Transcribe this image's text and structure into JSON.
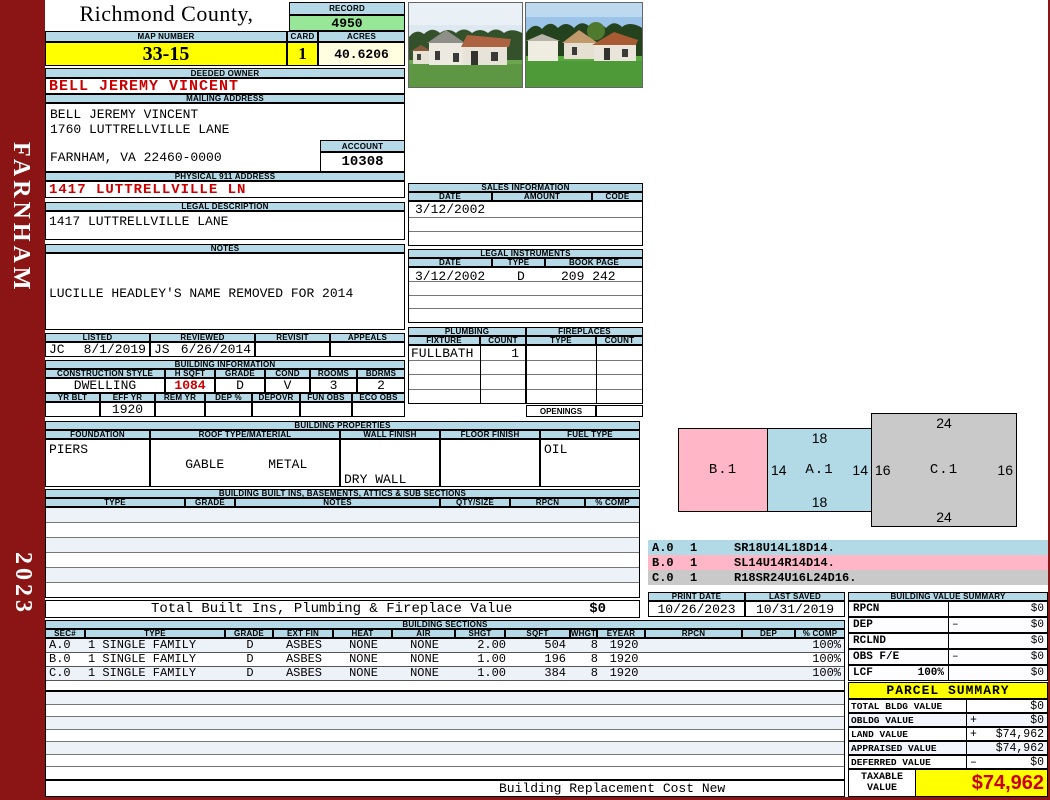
{
  "colors": {
    "frame_maroon": "#8b1414",
    "header_blue": "#b5d9e7",
    "record_green": "#98e698",
    "highlight_yellow": "#ffff00",
    "acres_cream": "#fffee0",
    "alert_red": "#cc0000",
    "sketch_pink": "#ffb6c6",
    "sketch_blue": "#b2dae6",
    "sketch_gray": "#c9c9c9"
  },
  "sidebar": {
    "district": "FARNHAM",
    "year": "2023"
  },
  "header": {
    "county_title": "Richmond County, Virginia",
    "county_subtitle": "Commissioner of the Revenue, PO Box 366, Warsaw, VA 22572",
    "record_label": "RECORD",
    "record_number": "4950",
    "map_number_label": "MAP NUMBER",
    "map_number": "33-15",
    "card_label": "CARD",
    "card_number": "1",
    "acres_label": "ACRES",
    "acres": "40.6206"
  },
  "owner": {
    "deeded_owner_label": "DEEDED OWNER",
    "deeded_owner": "BELL JEREMY VINCENT",
    "mailing_address_label": "MAILING ADDRESS",
    "mailing_line1": "BELL JEREMY VINCENT",
    "mailing_line2": "1760 LUTTRELLVILLE LANE",
    "mailing_line3": "FARNHAM, VA 22460-0000",
    "account_label": "ACCOUNT",
    "account_number": "10308",
    "physical_address_label": "PHYSICAL 911 ADDRESS",
    "physical_address": "1417 LUTTRELLVILLE LN",
    "legal_description_label": "LEGAL DESCRIPTION",
    "legal_description": "1417 LUTTRELLVILLE LANE",
    "notes_label": "NOTES",
    "notes_line1": "LUCILLE HEADLEY'S NAME REMOVED FOR 2014",
    "notes_line2": "(DIED 6/19/13) DB 209-242 TO JEREMY V",
    "notes_line3": "BELL"
  },
  "review": {
    "listed_label": "LISTED",
    "reviewed_label": "REVIEWED",
    "revisit_label": "REVISIT",
    "appeals_label": "APPEALS",
    "listed_by": "JC",
    "listed_date": "8/1/2019",
    "reviewed_by": "JS",
    "reviewed_date": "6/26/2014",
    "revisit": "",
    "appeals": ""
  },
  "building_info": {
    "title": "BUILDING INFORMATION",
    "construction_style_label": "CONSTRUCTION STYLE",
    "construction_style": "DWELLING",
    "h_sqft_label": "H SQFT",
    "h_sqft": "1084",
    "grade_label": "GRADE",
    "grade": "D",
    "cond_label": "COND",
    "cond": "V",
    "rooms_label": "ROOMS",
    "rooms": "3",
    "bdrms_label": "BDRMS",
    "bdrms": "2",
    "yr_blt_label": "YR BLT",
    "yr_blt": "",
    "eff_yr_label": "EFF YR",
    "eff_yr": "1920",
    "rem_yr_label": "REM YR",
    "rem_yr": "",
    "dep_pct_label": "DEP %",
    "dep_pct": "",
    "depovr_label": "DEPOVR",
    "depovr": "",
    "fun_obs_label": "FUN OBS",
    "fun_obs": "",
    "eco_obs_label": "ECO OBS",
    "eco_obs": ""
  },
  "building_props": {
    "title": "BUILDING PROPERTIES",
    "foundation_label": "FOUNDATION",
    "foundation": "PIERS",
    "roof_label": "ROOF TYPE/MATERIAL",
    "roof_type": "GABLE",
    "roof_material": "METAL",
    "wall_label": "WALL FINISH",
    "wall_finish1": "DRY WALL",
    "wall_finish2": "PLASTER",
    "floor_label": "FLOOR FINISH",
    "floor_finish": "",
    "fuel_label": "FUEL TYPE",
    "fuel_type": "OIL"
  },
  "built_ins": {
    "title": "BUILDING BUILT INS, BASEMENTS, ATTICS & SUB SECTIONS",
    "headers": [
      "TYPE",
      "GRADE",
      "NOTES",
      "QTY/SIZE",
      "RPCN",
      "% COMP"
    ]
  },
  "totals": {
    "built_ins_label": "Total Built Ins, Plumbing & Fireplace Value",
    "built_ins_value": "$0"
  },
  "sales": {
    "title": "SALES INFORMATION",
    "date_label": "DATE",
    "amount_label": "AMOUNT",
    "code_label": "CODE",
    "rows": [
      {
        "date": "3/12/2002",
        "amount": "",
        "code": ""
      }
    ]
  },
  "legal_instruments": {
    "title": "LEGAL INSTRUMENTS",
    "date_label": "DATE",
    "type_label": "TYPE",
    "bookpage_label": "BOOK PAGE",
    "rows": [
      {
        "date": "3/12/2002",
        "type": "D",
        "bookpage": "209 242"
      }
    ]
  },
  "plumbing": {
    "title": "PLUMBING",
    "fixture_label": "FIXTURE",
    "count_label": "COUNT",
    "rows": [
      {
        "fixture": "FULLBATH",
        "count": "1"
      }
    ]
  },
  "fireplaces": {
    "title": "FIREPLACES",
    "type_label": "TYPE",
    "count_label": "COUNT",
    "openings_label": "OPENINGS",
    "openings_value": ""
  },
  "sketch": {
    "b1": {
      "id": "B.1"
    },
    "a1": {
      "id": "A.1",
      "top": "18",
      "left": "14",
      "right": "14",
      "bottom": "18"
    },
    "c1": {
      "id": "C.1",
      "top": "24",
      "left": "16",
      "right": "16",
      "bottom": "24"
    },
    "legend": [
      {
        "sec": "A.0",
        "count": "1",
        "trace": "SR18U14L18D14."
      },
      {
        "sec": "B.0",
        "count": "1",
        "trace": "SL14U14R14D14."
      },
      {
        "sec": "C.0",
        "count": "1",
        "trace": "R18SR24U16L24D16."
      }
    ]
  },
  "dates": {
    "print_date_label": "PRINT DATE",
    "print_date": "10/26/2023",
    "last_saved_label": "LAST SAVED",
    "last_saved": "10/31/2019"
  },
  "bvs": {
    "title": "BUILDING VALUE SUMMARY",
    "rows": [
      {
        "label": "RPCN",
        "extra": "",
        "op": "",
        "value": "$0"
      },
      {
        "label": "DEP",
        "extra": "",
        "op": "–",
        "value": "$0"
      },
      {
        "label": "RCLND",
        "extra": "",
        "op": "",
        "value": "$0"
      },
      {
        "label": "OBS F/E",
        "extra": "",
        "op": "–",
        "value": "$0"
      },
      {
        "label": "LCF",
        "extra": "100%",
        "op": "",
        "value": "$0"
      }
    ]
  },
  "building_sections": {
    "title": "BUILDING SECTIONS",
    "headers": [
      "SEC#",
      "TYPE",
      "GRADE",
      "EXT FIN",
      "HEAT",
      "AIR",
      "SHGT",
      "SQFT",
      "WHGT",
      "EYEAR",
      "RPCN",
      "DEP",
      "% COMP"
    ],
    "rows": [
      [
        "A.0",
        "1 SINGLE FAMILY",
        "D",
        "ASBES",
        "NONE",
        "NONE",
        "2.00",
        "504",
        "8",
        "1920",
        "",
        "",
        "100%"
      ],
      [
        "B.0",
        "1 SINGLE FAMILY",
        "D",
        "ASBES",
        "NONE",
        "NONE",
        "1.00",
        "196",
        "8",
        "1920",
        "",
        "",
        "100%"
      ],
      [
        "C.0",
        "1 SINGLE FAMILY",
        "D",
        "ASBES",
        "NONE",
        "NONE",
        "1.00",
        "384",
        "8",
        "1920",
        "",
        "",
        "100%"
      ]
    ]
  },
  "parcel_summary": {
    "title": "PARCEL SUMMARY",
    "rows": [
      {
        "label": "TOTAL BLDG VALUE",
        "op": "",
        "value": "$0"
      },
      {
        "label": "OBLDG VALUE",
        "op": "+",
        "value": "$0"
      },
      {
        "label": "LAND VALUE",
        "op": "+",
        "value": "$74,962"
      },
      {
        "label": "APPRAISED VALUE",
        "op": "",
        "value": "$74,962"
      },
      {
        "label": "DEFERRED VALUE",
        "op": "–",
        "value": "$0"
      }
    ],
    "taxable_label_line1": "TAXABLE",
    "taxable_label_line2": "VALUE",
    "taxable_value": "$74,962"
  },
  "footer": {
    "text": "Building Replacement Cost New"
  }
}
